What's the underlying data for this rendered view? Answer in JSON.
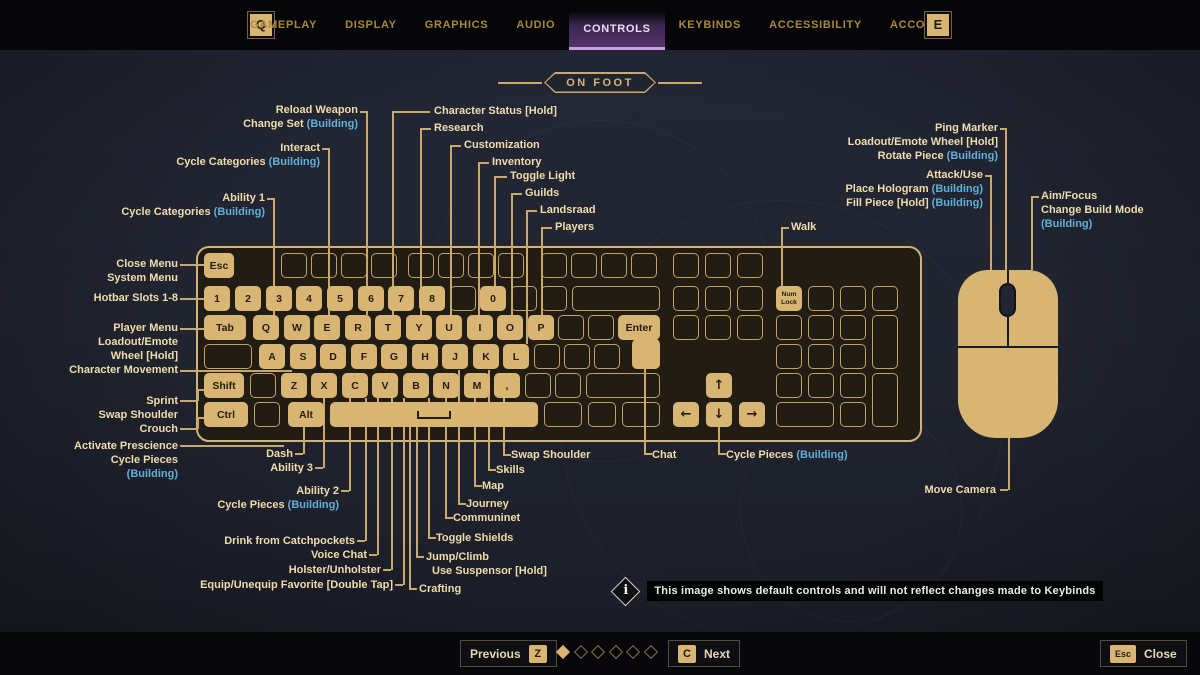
{
  "header": {
    "left_key_badge": "Q",
    "right_key_badge": "E",
    "tabs": [
      {
        "label": "GAMEPLAY",
        "active": false
      },
      {
        "label": "DISPLAY",
        "active": false
      },
      {
        "label": "GRAPHICS",
        "active": false
      },
      {
        "label": "AUDIO",
        "active": false
      },
      {
        "label": "CONTROLS",
        "active": true
      },
      {
        "label": "KEYBINDS",
        "active": false
      },
      {
        "label": "ACCESSIBILITY",
        "active": false
      },
      {
        "label": "ACCOUNT",
        "active": false
      }
    ]
  },
  "section": {
    "title": "ON FOOT"
  },
  "colors": {
    "gold": "#d9b574",
    "line": "#c9a96b",
    "label": "#efdcab",
    "building": "#5fb0d8",
    "accent_tab": "#d29ae2",
    "key_text": "#241c10"
  },
  "keyboard": {
    "keys": [
      [
        "Esc",
        204,
        253,
        30,
        25,
        1
      ],
      [
        "",
        281,
        253,
        26,
        25,
        0
      ],
      [
        "",
        311,
        253,
        26,
        25,
        0
      ],
      [
        "",
        341,
        253,
        26,
        25,
        0
      ],
      [
        "",
        371,
        253,
        26,
        25,
        0
      ],
      [
        "",
        408,
        253,
        26,
        25,
        0
      ],
      [
        "",
        438,
        253,
        26,
        25,
        0
      ],
      [
        "",
        468,
        253,
        26,
        25,
        0
      ],
      [
        "",
        498,
        253,
        26,
        25,
        0
      ],
      [
        "",
        541,
        253,
        26,
        25,
        0
      ],
      [
        "",
        571,
        253,
        26,
        25,
        0
      ],
      [
        "",
        601,
        253,
        26,
        25,
        0
      ],
      [
        "",
        631,
        253,
        26,
        25,
        0
      ],
      [
        "",
        673,
        253,
        26,
        25,
        0
      ],
      [
        "",
        705,
        253,
        26,
        25,
        0
      ],
      [
        "",
        737,
        253,
        26,
        25,
        0
      ],
      [
        "1",
        204,
        286,
        26,
        25,
        1
      ],
      [
        "2",
        235,
        286,
        26,
        25,
        1
      ],
      [
        "3",
        266,
        286,
        26,
        25,
        1
      ],
      [
        "4",
        296,
        286,
        26,
        25,
        1
      ],
      [
        "5",
        327,
        286,
        26,
        25,
        1
      ],
      [
        "6",
        358,
        286,
        26,
        25,
        1
      ],
      [
        "7",
        388,
        286,
        26,
        25,
        1
      ],
      [
        "8",
        419,
        286,
        26,
        25,
        1
      ],
      [
        "",
        450,
        286,
        26,
        25,
        0
      ],
      [
        "0",
        480,
        286,
        26,
        25,
        1
      ],
      [
        "",
        511,
        286,
        26,
        25,
        0
      ],
      [
        "",
        541,
        286,
        26,
        25,
        0
      ],
      [
        "",
        572,
        286,
        88,
        25,
        0
      ],
      [
        "",
        673,
        286,
        26,
        25,
        0
      ],
      [
        "",
        705,
        286,
        26,
        25,
        0
      ],
      [
        "",
        737,
        286,
        26,
        25,
        0
      ],
      [
        "Num Lock",
        776,
        286,
        26,
        25,
        1
      ],
      [
        "",
        808,
        286,
        26,
        25,
        0
      ],
      [
        "",
        840,
        286,
        26,
        25,
        0
      ],
      [
        "",
        872,
        286,
        26,
        25,
        0
      ],
      [
        "Tab",
        204,
        315,
        42,
        25,
        1
      ],
      [
        "Q",
        253,
        315,
        26,
        25,
        1
      ],
      [
        "W",
        284,
        315,
        26,
        25,
        1
      ],
      [
        "E",
        314,
        315,
        26,
        25,
        1
      ],
      [
        "R",
        345,
        315,
        26,
        25,
        1
      ],
      [
        "T",
        375,
        315,
        26,
        25,
        1
      ],
      [
        "Y",
        406,
        315,
        26,
        25,
        1
      ],
      [
        "U",
        436,
        315,
        26,
        25,
        1
      ],
      [
        "I",
        467,
        315,
        26,
        25,
        1
      ],
      [
        "O",
        497,
        315,
        26,
        25,
        1
      ],
      [
        "P",
        528,
        315,
        26,
        25,
        1
      ],
      [
        "",
        558,
        315,
        26,
        25,
        0
      ],
      [
        "",
        588,
        315,
        26,
        25,
        0
      ],
      [
        "Enter",
        618,
        315,
        42,
        25,
        1
      ],
      [
        "",
        632,
        339,
        28,
        30,
        1
      ],
      [
        "",
        673,
        315,
        26,
        25,
        0
      ],
      [
        "",
        705,
        315,
        26,
        25,
        0
      ],
      [
        "",
        737,
        315,
        26,
        25,
        0
      ],
      [
        "",
        776,
        315,
        26,
        25,
        0
      ],
      [
        "",
        808,
        315,
        26,
        25,
        0
      ],
      [
        "",
        840,
        315,
        26,
        25,
        0
      ],
      [
        "",
        872,
        315,
        26,
        54,
        0
      ],
      [
        "",
        204,
        344,
        48,
        25,
        0
      ],
      [
        "A",
        259,
        344,
        26,
        25,
        1
      ],
      [
        "S",
        290,
        344,
        26,
        25,
        1
      ],
      [
        "D",
        320,
        344,
        26,
        25,
        1
      ],
      [
        "F",
        351,
        344,
        26,
        25,
        1
      ],
      [
        "G",
        381,
        344,
        26,
        25,
        1
      ],
      [
        "H",
        412,
        344,
        26,
        25,
        1
      ],
      [
        "J",
        442,
        344,
        26,
        25,
        1
      ],
      [
        "K",
        473,
        344,
        26,
        25,
        1
      ],
      [
        "L",
        503,
        344,
        26,
        25,
        1
      ],
      [
        "",
        534,
        344,
        26,
        25,
        0
      ],
      [
        "",
        564,
        344,
        26,
        25,
        0
      ],
      [
        "",
        594,
        344,
        26,
        25,
        0
      ],
      [
        "",
        776,
        344,
        26,
        25,
        0
      ],
      [
        "",
        808,
        344,
        26,
        25,
        0
      ],
      [
        "",
        840,
        344,
        26,
        25,
        0
      ],
      [
        "Shift",
        204,
        373,
        40,
        25,
        1
      ],
      [
        "",
        250,
        373,
        26,
        25,
        0
      ],
      [
        "Z",
        281,
        373,
        26,
        25,
        1
      ],
      [
        "X",
        311,
        373,
        26,
        25,
        1
      ],
      [
        "C",
        342,
        373,
        26,
        25,
        1
      ],
      [
        "V",
        372,
        373,
        26,
        25,
        1
      ],
      [
        "B",
        403,
        373,
        26,
        25,
        1
      ],
      [
        "N",
        433,
        373,
        26,
        25,
        1
      ],
      [
        "M",
        464,
        373,
        26,
        25,
        1
      ],
      [
        ",",
        494,
        373,
        26,
        25,
        1
      ],
      [
        "",
        525,
        373,
        26,
        25,
        0
      ],
      [
        "",
        555,
        373,
        26,
        25,
        0
      ],
      [
        "",
        586,
        373,
        74,
        25,
        0
      ],
      [
        "↑",
        706,
        373,
        26,
        25,
        1
      ],
      [
        "",
        776,
        373,
        26,
        25,
        0
      ],
      [
        "",
        808,
        373,
        26,
        25,
        0
      ],
      [
        "",
        840,
        373,
        26,
        25,
        0
      ],
      [
        "",
        872,
        373,
        26,
        54,
        0
      ],
      [
        "Ctrl",
        204,
        402,
        44,
        25,
        1
      ],
      [
        "",
        254,
        402,
        26,
        25,
        0
      ],
      [
        "Alt",
        288,
        402,
        36,
        25,
        1
      ],
      [
        "SPACE",
        330,
        402,
        208,
        25,
        1
      ],
      [
        "",
        544,
        402,
        38,
        25,
        0
      ],
      [
        "",
        588,
        402,
        28,
        25,
        0
      ],
      [
        "",
        622,
        402,
        38,
        25,
        0
      ],
      [
        "←",
        673,
        402,
        26,
        25,
        1
      ],
      [
        "↓",
        706,
        402,
        26,
        25,
        1
      ],
      [
        "→",
        739,
        402,
        26,
        25,
        1
      ],
      [
        "",
        776,
        402,
        58,
        25,
        0
      ],
      [
        "",
        840,
        402,
        26,
        25,
        0
      ]
    ]
  },
  "connectors": [
    [
      "h",
      360,
      111,
      8
    ],
    [
      "v",
      366,
      111,
      204
    ],
    [
      "h",
      322,
      148,
      8
    ],
    [
      "v",
      328,
      148,
      167
    ],
    [
      "h",
      267,
      198,
      8
    ],
    [
      "v",
      273,
      198,
      117
    ],
    [
      "h",
      392,
      111,
      38
    ],
    [
      "v",
      392,
      111,
      204
    ],
    [
      "h",
      420,
      128,
      11
    ],
    [
      "v",
      420,
      128,
      187
    ],
    [
      "h",
      450,
      145,
      11
    ],
    [
      "v",
      450,
      145,
      170
    ],
    [
      "h",
      478,
      162,
      11
    ],
    [
      "v",
      478,
      162,
      153
    ],
    [
      "h",
      494,
      176,
      13
    ],
    [
      "v",
      494,
      176,
      110
    ],
    [
      "h",
      511,
      193,
      11
    ],
    [
      "v",
      511,
      193,
      122
    ],
    [
      "h",
      526,
      210,
      11
    ],
    [
      "v",
      526,
      210,
      134
    ],
    [
      "h",
      541,
      227,
      11
    ],
    [
      "v",
      541,
      227,
      88
    ],
    [
      "h",
      1000,
      128,
      7
    ],
    [
      "v",
      1005,
      128,
      155
    ],
    [
      "h",
      985,
      175,
      7
    ],
    [
      "v",
      990,
      175,
      95
    ],
    [
      "h",
      1031,
      196,
      8
    ],
    [
      "v",
      1031,
      196,
      74
    ],
    [
      "h",
      781,
      227,
      8
    ],
    [
      "v",
      781,
      227,
      59
    ],
    [
      "h",
      180,
      264,
      24
    ],
    [
      "h",
      180,
      298,
      24
    ],
    [
      "h",
      180,
      328,
      24
    ],
    [
      "h",
      180,
      370,
      112
    ],
    [
      "h",
      180,
      400,
      17
    ],
    [
      "v",
      197,
      389,
      12
    ],
    [
      "h",
      197,
      389,
      7
    ],
    [
      "h",
      180,
      428,
      17
    ],
    [
      "v",
      197,
      417,
      12
    ],
    [
      "h",
      197,
      417,
      7
    ],
    [
      "h",
      180,
      445,
      104
    ],
    [
      "v",
      303,
      427,
      27
    ],
    [
      "h",
      295,
      453,
      8
    ],
    [
      "v",
      323,
      398,
      70
    ],
    [
      "h",
      315,
      467,
      8
    ],
    [
      "v",
      349,
      398,
      93
    ],
    [
      "h",
      341,
      490,
      8
    ],
    [
      "v",
      365,
      398,
      143
    ],
    [
      "h",
      357,
      540,
      8
    ],
    [
      "v",
      377,
      398,
      157
    ],
    [
      "h",
      369,
      554,
      8
    ],
    [
      "v",
      391,
      398,
      172
    ],
    [
      "h",
      383,
      569,
      8
    ],
    [
      "v",
      403,
      398,
      187
    ],
    [
      "h",
      395,
      584,
      8
    ],
    [
      "v",
      409,
      427,
      162
    ],
    [
      "h",
      409,
      588,
      8
    ],
    [
      "v",
      416,
      427,
      130
    ],
    [
      "h",
      416,
      556,
      8
    ],
    [
      "v",
      428,
      398,
      140
    ],
    [
      "h",
      428,
      537,
      8
    ],
    [
      "v",
      445,
      398,
      120
    ],
    [
      "h",
      445,
      517,
      8
    ],
    [
      "v",
      458,
      370,
      134
    ],
    [
      "h",
      458,
      503,
      8
    ],
    [
      "v",
      474,
      398,
      88
    ],
    [
      "h",
      474,
      485,
      8
    ],
    [
      "v",
      488,
      370,
      100
    ],
    [
      "h",
      488,
      469,
      8
    ],
    [
      "v",
      503,
      398,
      57
    ],
    [
      "h",
      503,
      454,
      8
    ],
    [
      "v",
      644,
      369,
      85
    ],
    [
      "h",
      644,
      453,
      8
    ],
    [
      "v",
      718,
      427,
      27
    ],
    [
      "h",
      718,
      453,
      8
    ],
    [
      "v",
      1008,
      438,
      52
    ],
    [
      "h",
      1000,
      489,
      8
    ]
  ],
  "callouts": [
    {
      "a": "r",
      "x": 358,
      "y": 103,
      "lines": [
        "Reload Weapon",
        "Change Set (Building)"
      ]
    },
    {
      "a": "r",
      "x": 320,
      "y": 141,
      "lines": [
        "Interact",
        "Cycle Categories (Building)"
      ]
    },
    {
      "a": "r",
      "x": 265,
      "y": 191,
      "lines": [
        "Ability 1",
        "Cycle Categories (Building)"
      ]
    },
    {
      "a": "l",
      "x": 434,
      "y": 104,
      "lines": [
        "Character Status [Hold]"
      ]
    },
    {
      "a": "l",
      "x": 434,
      "y": 121,
      "lines": [
        "Research"
      ]
    },
    {
      "a": "l",
      "x": 464,
      "y": 138,
      "lines": [
        "Customization"
      ]
    },
    {
      "a": "l",
      "x": 492,
      "y": 155,
      "lines": [
        "Inventory"
      ]
    },
    {
      "a": "l",
      "x": 510,
      "y": 169,
      "lines": [
        "Toggle Light"
      ]
    },
    {
      "a": "l",
      "x": 525,
      "y": 186,
      "lines": [
        "Guilds"
      ]
    },
    {
      "a": "l",
      "x": 540,
      "y": 203,
      "lines": [
        "Landsraad"
      ]
    },
    {
      "a": "l",
      "x": 555,
      "y": 220,
      "lines": [
        "Players"
      ]
    },
    {
      "a": "r",
      "x": 998,
      "y": 121,
      "lines": [
        "Ping Marker",
        "Loadout/Emote Wheel [Hold]",
        "Rotate Piece (Building)"
      ]
    },
    {
      "a": "r",
      "x": 983,
      "y": 168,
      "lines": [
        "Attack/Use",
        "Place Hologram (Building)",
        "Fill Piece [Hold] (Building)"
      ]
    },
    {
      "a": "l",
      "x": 1041,
      "y": 189,
      "lines": [
        "Aim/Focus",
        "Change Build Mode",
        "(Building)"
      ]
    },
    {
      "a": "l",
      "x": 791,
      "y": 220,
      "lines": [
        "Walk"
      ]
    },
    {
      "a": "r",
      "x": 178,
      "y": 257,
      "lines": [
        "Close Menu",
        "System Menu"
      ]
    },
    {
      "a": "r",
      "x": 178,
      "y": 291,
      "lines": [
        "Hotbar Slots 1-8"
      ]
    },
    {
      "a": "r",
      "x": 178,
      "y": 321,
      "lines": [
        "Player Menu",
        "Loadout/Emote",
        "Wheel [Hold]"
      ]
    },
    {
      "a": "r",
      "x": 178,
      "y": 363,
      "lines": [
        "Character Movement"
      ]
    },
    {
      "a": "r",
      "x": 178,
      "y": 394,
      "lines": [
        "Sprint"
      ]
    },
    {
      "a": "r",
      "x": 178,
      "y": 408,
      "lines": [
        "Swap Shoulder"
      ]
    },
    {
      "a": "r",
      "x": 178,
      "y": 422,
      "lines": [
        "Crouch"
      ]
    },
    {
      "a": "r",
      "x": 178,
      "y": 439,
      "lines": [
        "Activate Prescience",
        "Cycle Pieces",
        "(Building)"
      ]
    },
    {
      "a": "r",
      "x": 293,
      "y": 447,
      "lines": [
        "Dash"
      ]
    },
    {
      "a": "r",
      "x": 313,
      "y": 461,
      "lines": [
        "Ability 3"
      ]
    },
    {
      "a": "r",
      "x": 339,
      "y": 484,
      "lines": [
        "Ability 2",
        "Cycle Pieces (Building)"
      ]
    },
    {
      "a": "r",
      "x": 355,
      "y": 534,
      "lines": [
        "Drink from Catchpockets"
      ]
    },
    {
      "a": "r",
      "x": 367,
      "y": 548,
      "lines": [
        "Voice Chat"
      ]
    },
    {
      "a": "r",
      "x": 381,
      "y": 563,
      "lines": [
        "Holster/Unholster"
      ]
    },
    {
      "a": "r",
      "x": 393,
      "y": 578,
      "lines": [
        "Equip/Unequip Favorite [Double Tap]"
      ]
    },
    {
      "a": "l",
      "x": 419,
      "y": 582,
      "lines": [
        "Crafting"
      ]
    },
    {
      "a": "l",
      "x": 426,
      "y": 550,
      "lines": [
        "Jump/Climb"
      ]
    },
    {
      "a": "l",
      "x": 432,
      "y": 564,
      "lines": [
        "Use Suspensor [Hold]"
      ]
    },
    {
      "a": "l",
      "x": 436,
      "y": 531,
      "lines": [
        "Toggle Shields"
      ]
    },
    {
      "a": "l",
      "x": 453,
      "y": 511,
      "lines": [
        "Communinet"
      ]
    },
    {
      "a": "l",
      "x": 466,
      "y": 497,
      "lines": [
        "Journey"
      ]
    },
    {
      "a": "l",
      "x": 482,
      "y": 479,
      "lines": [
        "Map"
      ]
    },
    {
      "a": "l",
      "x": 496,
      "y": 463,
      "lines": [
        "Skills"
      ]
    },
    {
      "a": "l",
      "x": 511,
      "y": 448,
      "lines": [
        "Swap Shoulder"
      ]
    },
    {
      "a": "l",
      "x": 652,
      "y": 448,
      "lines": [
        "Chat"
      ]
    },
    {
      "a": "l",
      "x": 726,
      "y": 448,
      "lines": [
        "Cycle Pieces (Building)"
      ]
    },
    {
      "a": "r",
      "x": 996,
      "y": 483,
      "lines": [
        "Move Camera"
      ]
    }
  ],
  "info_bar": {
    "text": "This image shows default controls and will not reflect changes made to Keybinds"
  },
  "footer": {
    "previous_label": "Previous",
    "previous_key": "Z",
    "next_label": "Next",
    "next_key": "C",
    "close_label": "Close",
    "close_key": "Esc",
    "total_pages": 6,
    "current_page": 1
  }
}
